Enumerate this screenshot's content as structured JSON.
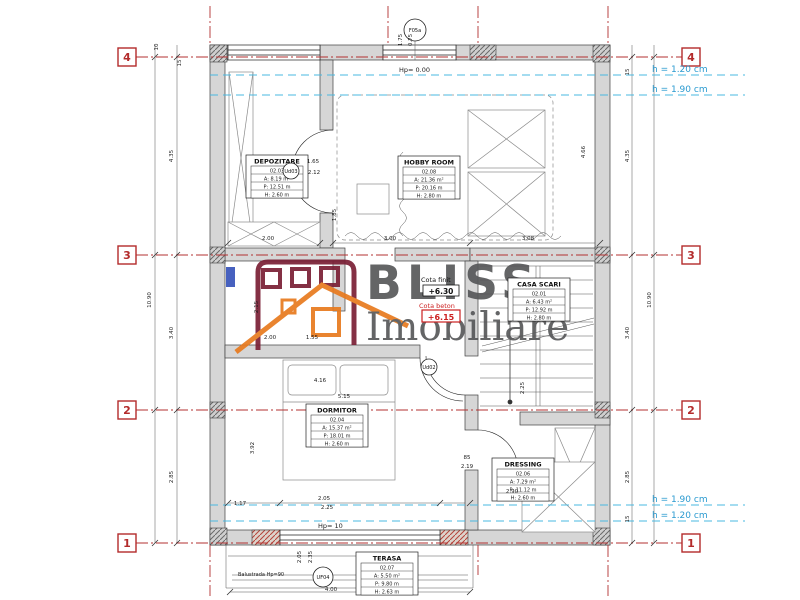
{
  "watermark": {
    "line1": "BLISS",
    "line2": "Imobiliare",
    "text_color": "#57585a",
    "roof_color": "#e87a1e",
    "window_color": "#7a1f35"
  },
  "levels": {
    "finish_label": "Cota finit",
    "finish_value": "+6.30",
    "concrete_label": "Cota beton",
    "concrete_value": "+6.15",
    "accent": "#cc2020"
  },
  "grid": {
    "color": "#b32b2b",
    "rows": [
      {
        "label": "4"
      },
      {
        "label": "3"
      },
      {
        "label": "2"
      },
      {
        "label": "1"
      }
    ]
  },
  "height_lines": {
    "color": "#2a9ad0",
    "top": [
      {
        "label": "h = 1.20 cm"
      },
      {
        "label": "h = 1.90 cm"
      }
    ],
    "bottom": [
      {
        "label": "h = 1.90 cm"
      },
      {
        "label": "h = 1.20 cm"
      }
    ]
  },
  "rooms": [
    {
      "name": "DEPOZITARE",
      "code": "02.03",
      "area": "A: 8.19 m²",
      "perimeter": "P: 12.51 m",
      "height": "H: 2.60 m",
      "x": 246,
      "y": 155
    },
    {
      "name": "HOBBY ROOM",
      "code": "02.08",
      "area": "A: 21.36 m²",
      "perimeter": "P: 20.16 m",
      "height": "H: 2.80 m",
      "x": 398,
      "y": 156
    },
    {
      "name": "CASA SCARI",
      "code": "02.01",
      "area": "A: 6.43 m²",
      "perimeter": "P: 12.92 m",
      "height": "H: 2.80 m",
      "x": 508,
      "y": 278
    },
    {
      "name": "DORMITOR",
      "code": "02.04",
      "area": "A: 15.37 m²",
      "perimeter": "P: 18.01 m",
      "height": "H: 2.60 m",
      "x": 306,
      "y": 404
    },
    {
      "name": "DRESSING",
      "code": "02.06",
      "area": "A: 7.29 m²",
      "perimeter": "P: 11.12 m",
      "height": "H: 2.60 m",
      "x": 492,
      "y": 458
    },
    {
      "name": "TERASA",
      "code": "02.07",
      "area": "A: 5.50 m²",
      "perimeter": "P: 9.80 m",
      "height": "H: 2.63 m",
      "x": 356,
      "y": 552
    }
  ],
  "tags": [
    {
      "label": "F05a",
      "x": 415,
      "y": 30,
      "r": 11
    },
    {
      "label": "Ud03",
      "x": 291,
      "y": 171,
      "r": 8
    },
    {
      "label": "Ud02",
      "x": 429,
      "y": 367,
      "r": 8
    },
    {
      "label": "UF04",
      "x": 323,
      "y": 577,
      "r": 10
    }
  ],
  "annotations": [
    {
      "text": "Hp= 0.00",
      "x": 399,
      "y": 72,
      "size": 6.5
    },
    {
      "text": "Hp= 10",
      "x": 318,
      "y": 528,
      "size": 6.5
    },
    {
      "text": "Balustrada Hp=90",
      "x": 238,
      "y": 576,
      "size": 5
    }
  ],
  "dimensions": [
    {
      "t": "10.90",
      "x": 151,
      "y": 300,
      "r": 1
    },
    {
      "t": "4.35",
      "x": 173,
      "y": 156,
      "r": 1
    },
    {
      "t": "3.40",
      "x": 173,
      "y": 333,
      "r": 1
    },
    {
      "t": "2.85",
      "x": 173,
      "y": 477,
      "r": 1
    },
    {
      "t": "10",
      "x": 158,
      "y": 47,
      "r": 1
    },
    {
      "t": "15",
      "x": 181,
      "y": 63,
      "r": 1
    },
    {
      "t": "4.35",
      "x": 629,
      "y": 156,
      "r": 1
    },
    {
      "t": "3.40",
      "x": 629,
      "y": 333,
      "r": 1
    },
    {
      "t": "2.85",
      "x": 629,
      "y": 477,
      "r": 1
    },
    {
      "t": "10.90",
      "x": 651,
      "y": 300,
      "r": 1
    },
    {
      "t": "15",
      "x": 629,
      "y": 72,
      "r": 1
    },
    {
      "t": "15",
      "x": 629,
      "y": 519,
      "r": 1
    },
    {
      "t": "2.00",
      "x": 268,
      "y": 240
    },
    {
      "t": "3.00",
      "x": 390,
      "y": 240
    },
    {
      "t": "3.08",
      "x": 528,
      "y": 240
    },
    {
      "t": "1.85",
      "x": 336,
      "y": 215,
      "r": 1
    },
    {
      "t": "4.66",
      "x": 585,
      "y": 152,
      "r": 1
    },
    {
      "t": "1.65",
      "x": 313,
      "y": 163
    },
    {
      "t": "2.12",
      "x": 314,
      "y": 174
    },
    {
      "t": "1.75",
      "x": 402,
      "y": 40,
      "r": 1
    },
    {
      "t": "0.75",
      "x": 412,
      "y": 40,
      "r": 1
    },
    {
      "t": "2.00",
      "x": 270,
      "y": 339
    },
    {
      "t": "1.55",
      "x": 312,
      "y": 339
    },
    {
      "t": "2.15",
      "x": 258,
      "y": 307,
      "r": 1
    },
    {
      "t": "4.16",
      "x": 320,
      "y": 382
    },
    {
      "t": "5.15",
      "x": 344,
      "y": 398
    },
    {
      "t": "3.92",
      "x": 254,
      "y": 448,
      "r": 1
    },
    {
      "t": "1.17",
      "x": 240,
      "y": 505
    },
    {
      "t": "2.05",
      "x": 324,
      "y": 500
    },
    {
      "t": "2.25",
      "x": 327,
      "y": 509
    },
    {
      "t": "85",
      "x": 467,
      "y": 459
    },
    {
      "t": "2.19",
      "x": 467,
      "y": 468
    },
    {
      "t": "2.90",
      "x": 512,
      "y": 493
    },
    {
      "t": "2.25",
      "x": 524,
      "y": 388,
      "r": 1
    },
    {
      "t": "2.05",
      "x": 301,
      "y": 557,
      "r": 1
    },
    {
      "t": "2.35",
      "x": 312,
      "y": 557,
      "r": 1
    },
    {
      "t": "4.00",
      "x": 331,
      "y": 591
    }
  ]
}
